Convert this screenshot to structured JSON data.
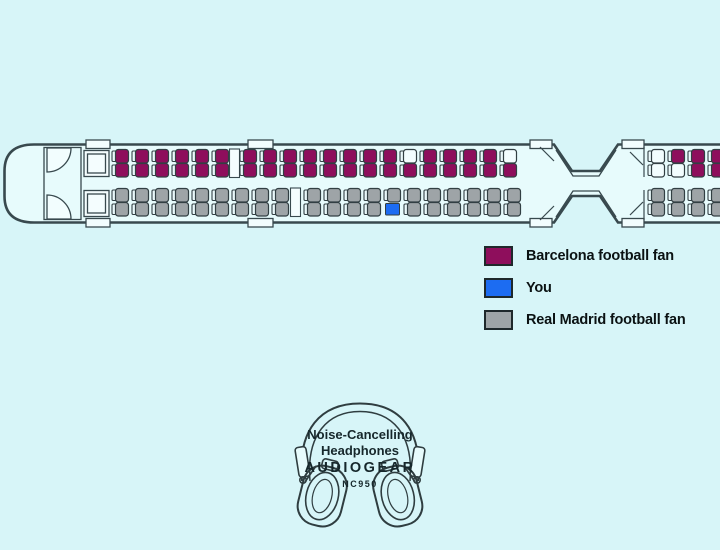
{
  "canvas": {
    "background": "#D7F5F8"
  },
  "legend": {
    "items": [
      {
        "code": "B",
        "label": "Barcelona football fan",
        "color": "#8E0E5C"
      },
      {
        "code": "Y",
        "label": "You",
        "color": "#1C6CF2"
      },
      {
        "code": "R",
        "label": "Real Madrid football fan",
        "color": "#9EA4A7"
      }
    ]
  },
  "seat_map": {
    "colors": {
      "B": "#8E0E5C",
      "Y": "#1C6CF2",
      "R": "#9EA4A7",
      "E": "#F2FDFE"
    },
    "backrest_fill": "#EAF9FB",
    "seat_stroke": "#323F43",
    "cars": [
      {
        "name": "car-1",
        "sections": [
          {
            "name": "top",
            "columns_x": [
              112,
              132,
              152,
              172,
              192,
              212,
              240,
              260,
              280,
              300,
              320,
              340,
              360,
              380,
              400,
              420,
              440,
              460,
              480,
              500
            ],
            "rows": [
              {
                "y": 149.5,
                "seats": "BBBBBBBBBBBBBBEBBBBE"
              },
              {
                "y": 163.5,
                "seats": "BBBBBBBBBBBBBBBBBBBB"
              }
            ]
          },
          {
            "name": "bottom",
            "columns_x": [
              112,
              132,
              152,
              172,
              192,
              212,
              232,
              252,
              272,
              304,
              324,
              344,
              364,
              384,
              404,
              424,
              444,
              464,
              484,
              504
            ],
            "rows": [
              {
                "y": 188.5,
                "seats": "RRRRRRRRRRRRRRRRRRRR"
              },
              {
                "y": 202.5,
                "seats": "RRRRRRRRRRRRRYRRRRRR"
              }
            ]
          }
        ]
      },
      {
        "name": "car-2",
        "sections": [
          {
            "name": "top",
            "columns_x": [
              648,
              668,
              688,
              708
            ],
            "rows": [
              {
                "y": 149.5,
                "seats": "EBBB"
              },
              {
                "y": 163.5,
                "seats": "EEBB"
              }
            ]
          },
          {
            "name": "bottom",
            "columns_x": [
              648,
              668,
              688,
              708
            ],
            "rows": [
              {
                "y": 188.5,
                "seats": "RRRR"
              },
              {
                "y": 202.5,
                "seats": "RRRR"
              }
            ]
          }
        ]
      }
    ]
  },
  "product": {
    "line1": "Noise-Cancelling",
    "line2": "Headphones",
    "brand": "AUDIOGEAR",
    "model": "NC950"
  }
}
